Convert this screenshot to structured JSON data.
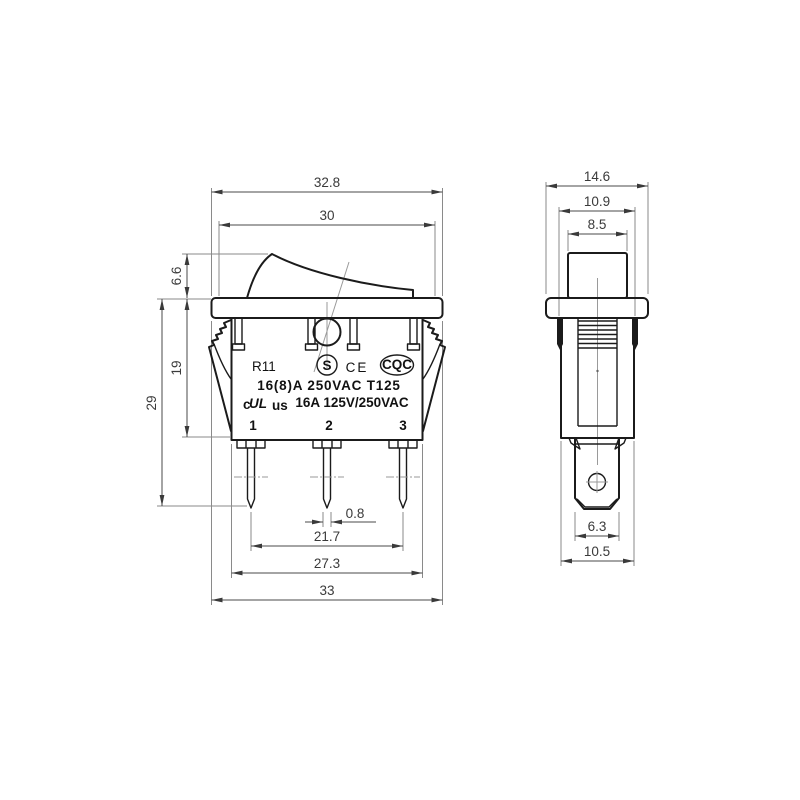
{
  "drawing": {
    "front_view": {
      "dim_width_top": "32.8",
      "dim_rocker_width": "30",
      "dim_rocker_height": "6.6",
      "dim_body_depth": "19",
      "dim_total_depth": "29",
      "dim_pin_thickness": "0.8",
      "dim_pin_span": "21.7",
      "dim_body_width": "27.3",
      "dim_overall_width": "33",
      "model": "R11",
      "cert_s": "S",
      "cert_ce": "CE",
      "cert_cqc": "CQC",
      "rating_line1": "16(8)A 250VAC T125",
      "ul_prefix": "c",
      "ul_mark": "UL",
      "ul_suffix": "us",
      "rating_line2": "16A 125V/250VAC",
      "terminal_1": "1",
      "terminal_2": "2",
      "terminal_3": "3"
    },
    "side_view": {
      "dim_flange_width": "14.6",
      "dim_clip_width": "10.9",
      "dim_rocker_depth": "8.5",
      "dim_terminal_width": "6.3",
      "dim_body_width": "10.5"
    }
  }
}
